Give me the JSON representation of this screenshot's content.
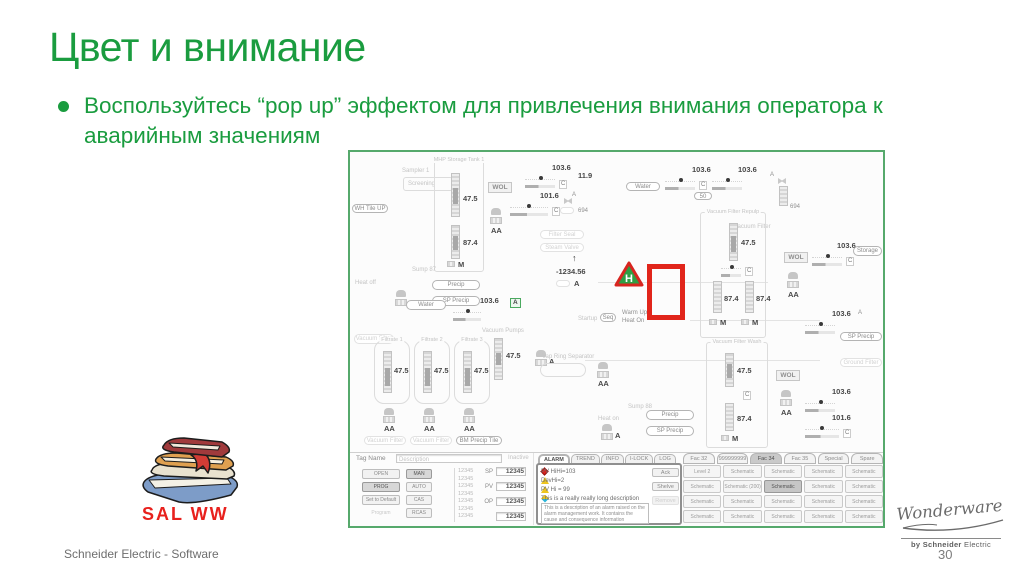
{
  "slide": {
    "title": "Цвет и внимание",
    "bullet": "Воспользуйтесь “pop up” эффектом для привлечения внимания оператора к аварийным значениям",
    "footer": "Schneider Electric - Software",
    "page_number": "30",
    "sal_label": "SAL  WW",
    "logo": {
      "brand": "Wonderware",
      "sub_bold": "by Schneider",
      "sub_light": "Electric"
    }
  },
  "colors": {
    "accent_green": "#1a9c3f",
    "alarm_red": "#e1251b",
    "frame_green": "#56a96c",
    "sal_red": "#e8211d"
  },
  "scada": {
    "labels": {
      "sampler": "Sampler 1",
      "screening": "Screening",
      "mhp": "MHP Storage Tank 1",
      "wol": "WOL",
      "vac_filter": "Vacuum Filter",
      "vac_repulp": "Vacuum Filter Repulp",
      "vac_wash": "Vacuum Filter Wash",
      "vac_pumps": "Vacuum Pumps",
      "filtrate1": "Filtrate 1",
      "filtrate2": "Filtrate 2",
      "filtrate3": "Filtrate 3",
      "vap_ring": "Vap Ring Separator",
      "sump87": "Sump 87",
      "sump88": "Sump 88",
      "warm_up": "Warm Up",
      "heat_on": "Heat On",
      "heat_on_small": "Heat on",
      "heat_off": "Heat off",
      "startup": "Startup",
      "filter_seal": "Filter Seal",
      "steam_valve": "Steam Valve",
      "ground_filter": "Ground Filter",
      "aa": "AA",
      "a": "A",
      "c": "C",
      "m": "M",
      "h": "H"
    },
    "values": {
      "v103": "103.6",
      "v101": "101.6",
      "v475": "47.5",
      "v874": "87.4",
      "v119": "11.9",
      "vneg": "-1234.56"
    },
    "buttons": {
      "wh_tile_up": "WH Tile UP",
      "water": "Water",
      "precip": "Precip",
      "sp_precip": "SP Precip",
      "seq": "Seq",
      "storage": "Storage",
      "v50": "50",
      "v694": "694",
      "vacuum_filter": "Vacuum Filter",
      "bm_precip": "BM Precip Tile"
    },
    "bottom": {
      "tag_name": "Tag Name",
      "description": "Description",
      "inactive": "Inactive",
      "mode_buttons": [
        {
          "label": "OPEN"
        },
        {
          "label": "MAN",
          "state": "pressed"
        },
        {
          "label": "PROG",
          "state": "pressed"
        },
        {
          "label": "AUTO"
        },
        {
          "label": "Set to Default"
        },
        {
          "label": "CAS"
        },
        {
          "label": "Program Cascade",
          "state": "faded"
        },
        {
          "label": "RCAS"
        }
      ],
      "scale_ticks": [
        "12345",
        "12345",
        "12345",
        "12345",
        "12345",
        "12345",
        "12345"
      ],
      "fields": [
        {
          "label": "SP",
          "value": "12345"
        },
        {
          "label": "PV",
          "value": "12345"
        },
        {
          "label": "OP",
          "value": "12345"
        },
        {
          "label": "",
          "value": "12345"
        }
      ],
      "alarm_tabs": [
        {
          "label": "ALARM",
          "state": "active"
        },
        {
          "label": "TREND"
        },
        {
          "label": "INFO"
        },
        {
          "label": "I-LOCK"
        },
        {
          "label": "LOG"
        }
      ],
      "alarms": [
        {
          "icon": "diamond",
          "text": "PV HiHi=103"
        },
        {
          "icon": "tri",
          "text": "DevHi=2"
        },
        {
          "icon": "tri",
          "text": "PV Hi = 99"
        },
        {
          "icon": "duo",
          "text": "This is a really really long description"
        }
      ],
      "alarm_buttons": [
        {
          "label": "Ack"
        },
        {
          "label": "Shelve"
        },
        {
          "label": "Remove",
          "state": "faded"
        }
      ],
      "alarm_desc": "This is a description of an alarm raised on the alarm management work. It contains the cause and consequence information",
      "fac_tabs": [
        {
          "label": "Fac 32"
        },
        {
          "label": "999999999"
        },
        {
          "label": "Fac 34",
          "state": "active"
        },
        {
          "label": "Fac 35"
        },
        {
          "label": "Special"
        },
        {
          "label": "Spare"
        }
      ],
      "schematic_cells": [
        {
          "label": "Level 2"
        },
        {
          "label": "Schematic"
        },
        {
          "label": "Schematic"
        },
        {
          "label": "Schematic"
        },
        {
          "label": "Schematic"
        },
        {
          "label": "Schematic"
        },
        {
          "label": "Schematic (200)"
        },
        {
          "label": "Schematic",
          "state": "pressed"
        },
        {
          "label": "Schematic"
        },
        {
          "label": "Schematic"
        },
        {
          "label": "Schematic"
        },
        {
          "label": "Schematic"
        },
        {
          "label": "Schematic"
        },
        {
          "label": "Schematic"
        },
        {
          "label": "Schematic"
        },
        {
          "label": "Schematic"
        },
        {
          "label": "Schematic"
        },
        {
          "label": "Schematic"
        },
        {
          "label": "Schematic"
        },
        {
          "label": "Schematic"
        }
      ]
    }
  }
}
